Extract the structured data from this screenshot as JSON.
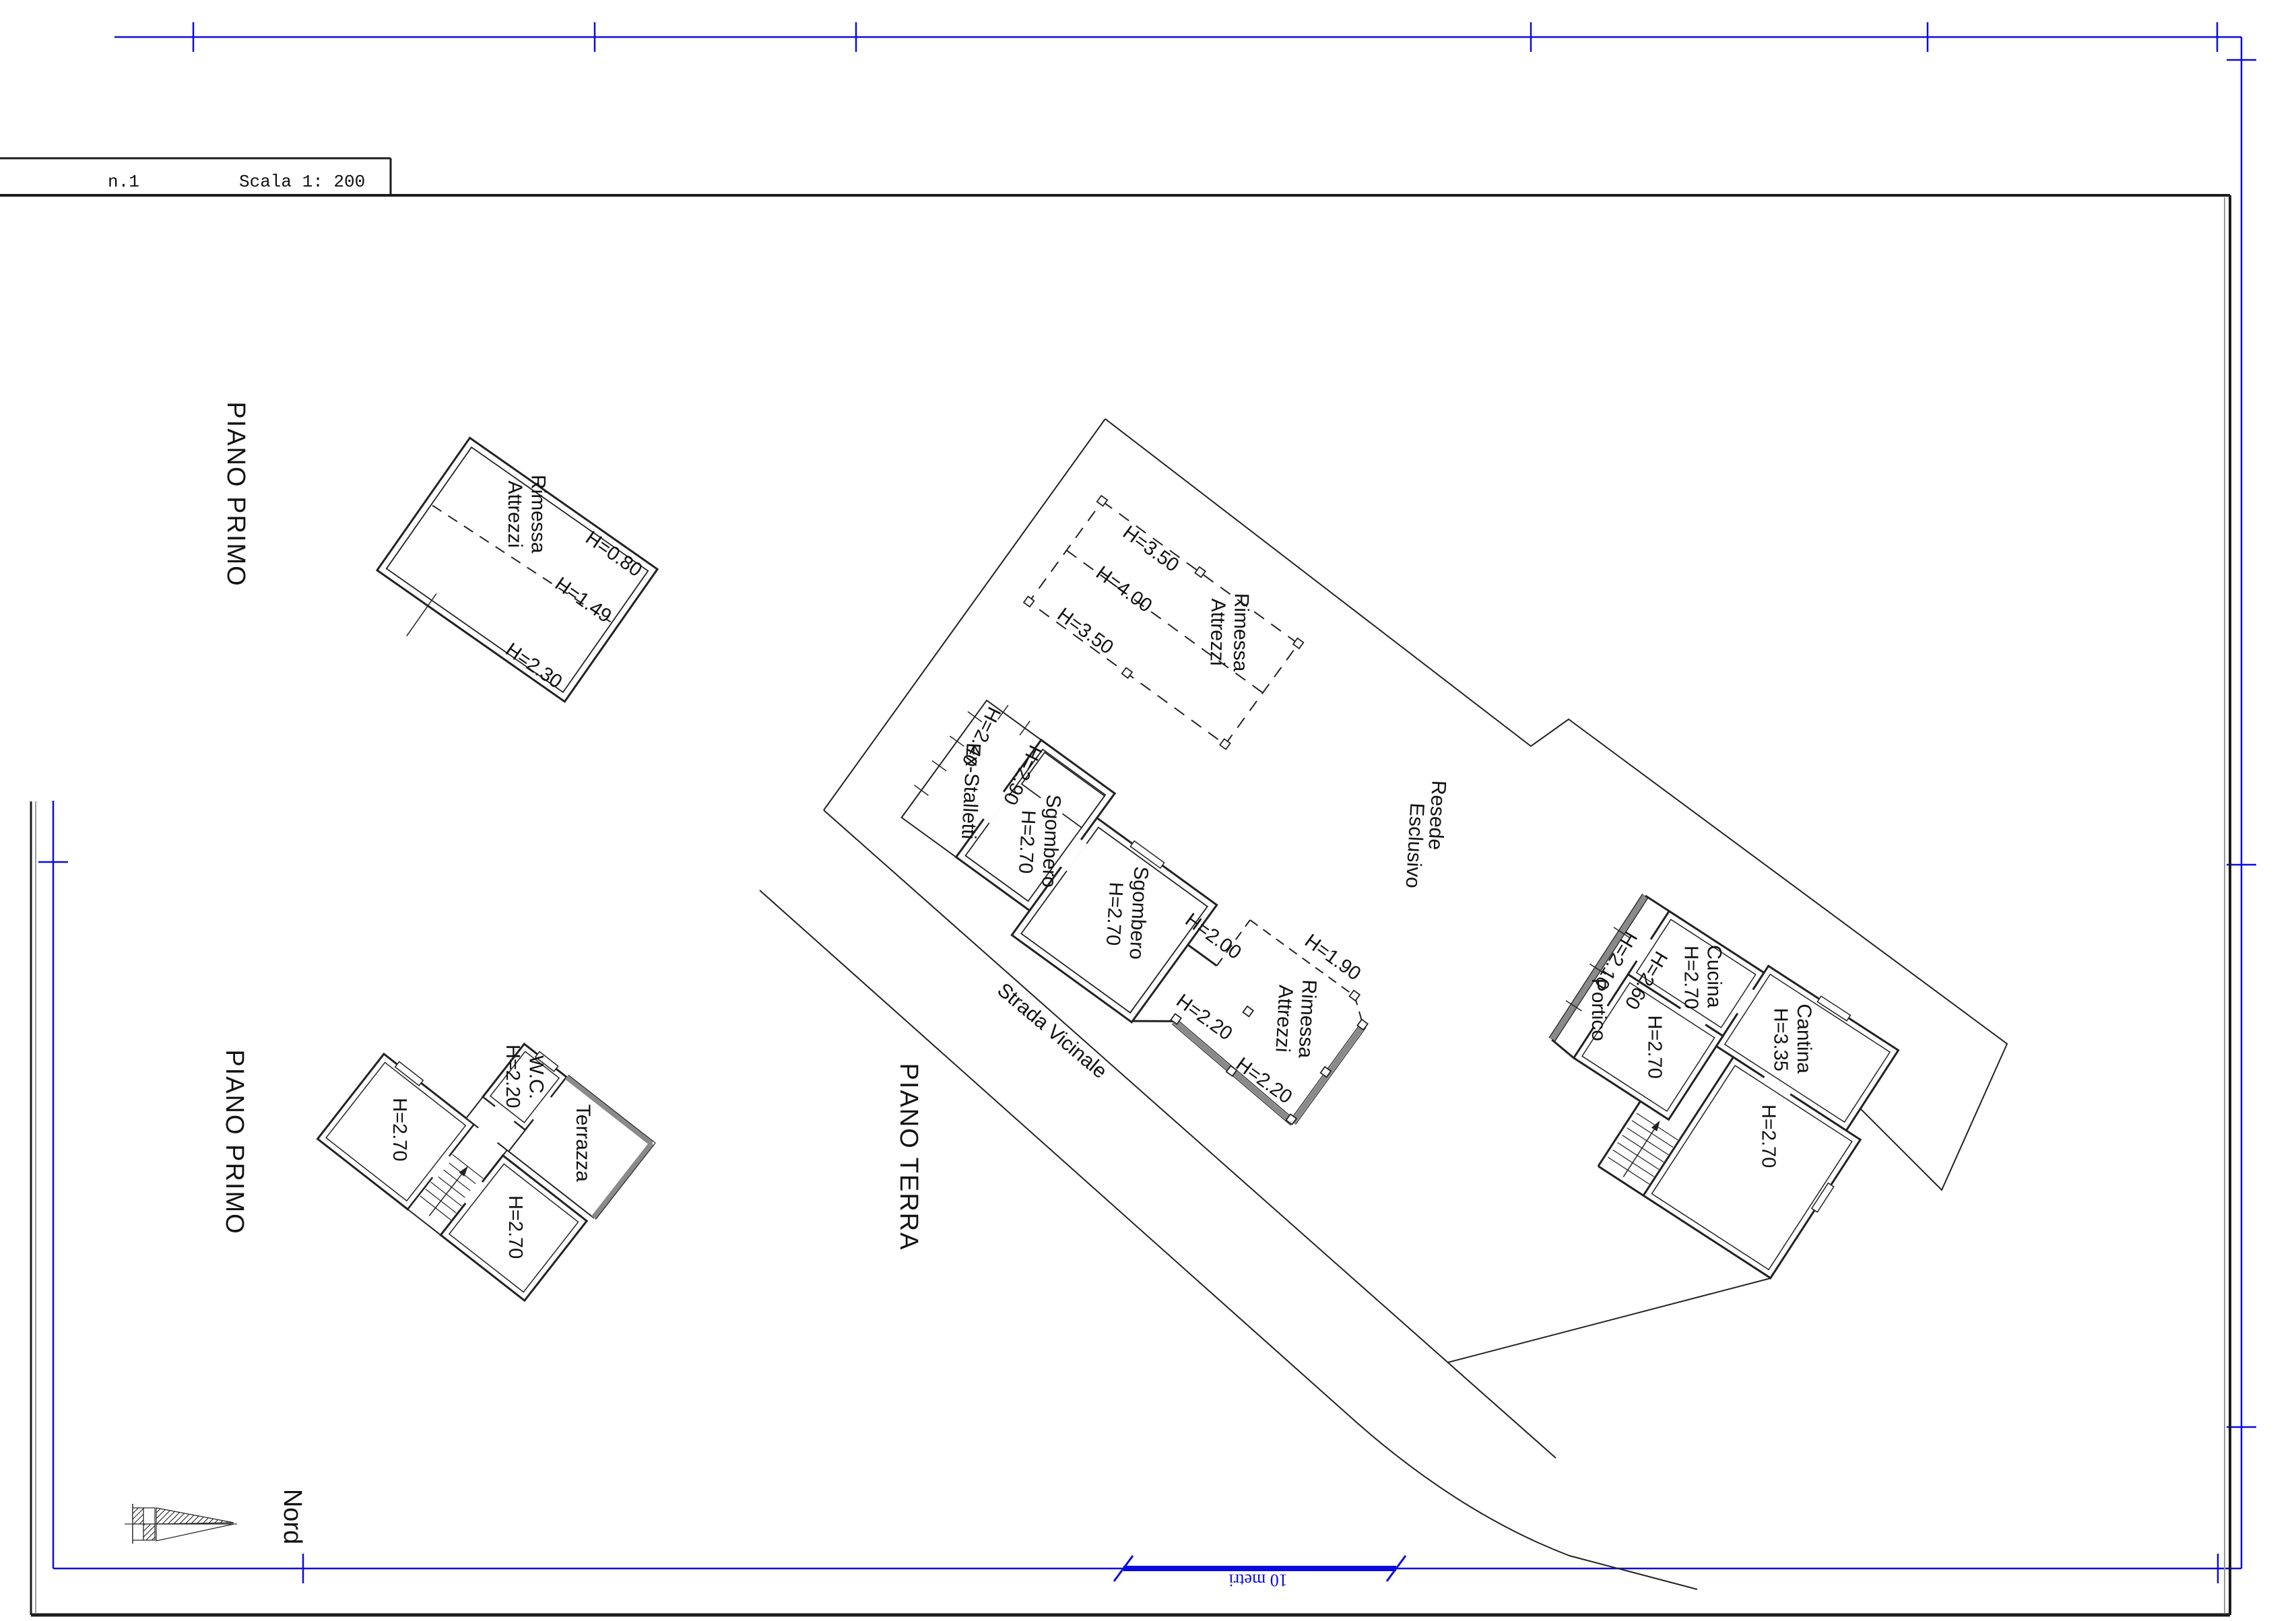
{
  "colors": {
    "frame_blue": "#0b0be0",
    "line_black": "#222222",
    "wall_gray": "#8a8a8a"
  },
  "sheet": {
    "doc_number": "n.1",
    "scale_label": "Scala 1: 200",
    "north_label": "Nord",
    "scale_bar_label": "10 metri"
  },
  "floor_labels": {
    "piano_primo_top": "PIANO PRIMO",
    "piano_primo_bottom": "PIANO PRIMO",
    "piano_terra": "PIANO TERRA"
  },
  "site": {
    "resede_line1": "Resede",
    "resede_line2": "Esclusivo",
    "road": "Strada Vicinale"
  },
  "attic_plan": {
    "name_line1": "Rimessa",
    "name_line2": "Attrezzi",
    "h_a": "H=0.80",
    "h_b": "H=1.49",
    "h_c": "H=2.30"
  },
  "barn_plan": {
    "shed_name_line1": "Rimessa",
    "shed_name_line2": "Attrezzi",
    "shed_h_top": "H=3.50",
    "shed_h_mid": "H=4.00",
    "shed_h_bottom": "H=3.50",
    "stall_name": "Ex-Stalletti",
    "stall_h": "H=2.40",
    "wall_h": "H=2.90",
    "sgombero1_name": "Sgombero",
    "sgombero1_h": "H=2.70",
    "sgombero2_name": "Sgombero",
    "sgombero2_h": "H=2.70",
    "open_wall_h": "H=2.00",
    "rimessa_name_line1": "Rimessa",
    "rimessa_name_line2": "Attrezzi",
    "rimessa_h": "H=1.90",
    "sw_wall_h_upper": "H=2.20",
    "sw_wall_h_lower": "H=2.20"
  },
  "house_plan": {
    "portico": "Portico",
    "portico_h": "H=2.10",
    "inner_h": "H=2.60",
    "cucina": "Cucina",
    "cucina_h": "H=2.70",
    "cantina": "Cantina",
    "cantina_h": "H=3.35",
    "room_left_h": "H=2.70",
    "room_bottom_h": "H=2.70"
  },
  "upper_floor_plan": {
    "room_left_h": "H=2.70",
    "wc": "W.C.",
    "wc_h": "H=2.20",
    "terrazza": "Terrazza",
    "room_bottom_h": "H=2.70"
  }
}
